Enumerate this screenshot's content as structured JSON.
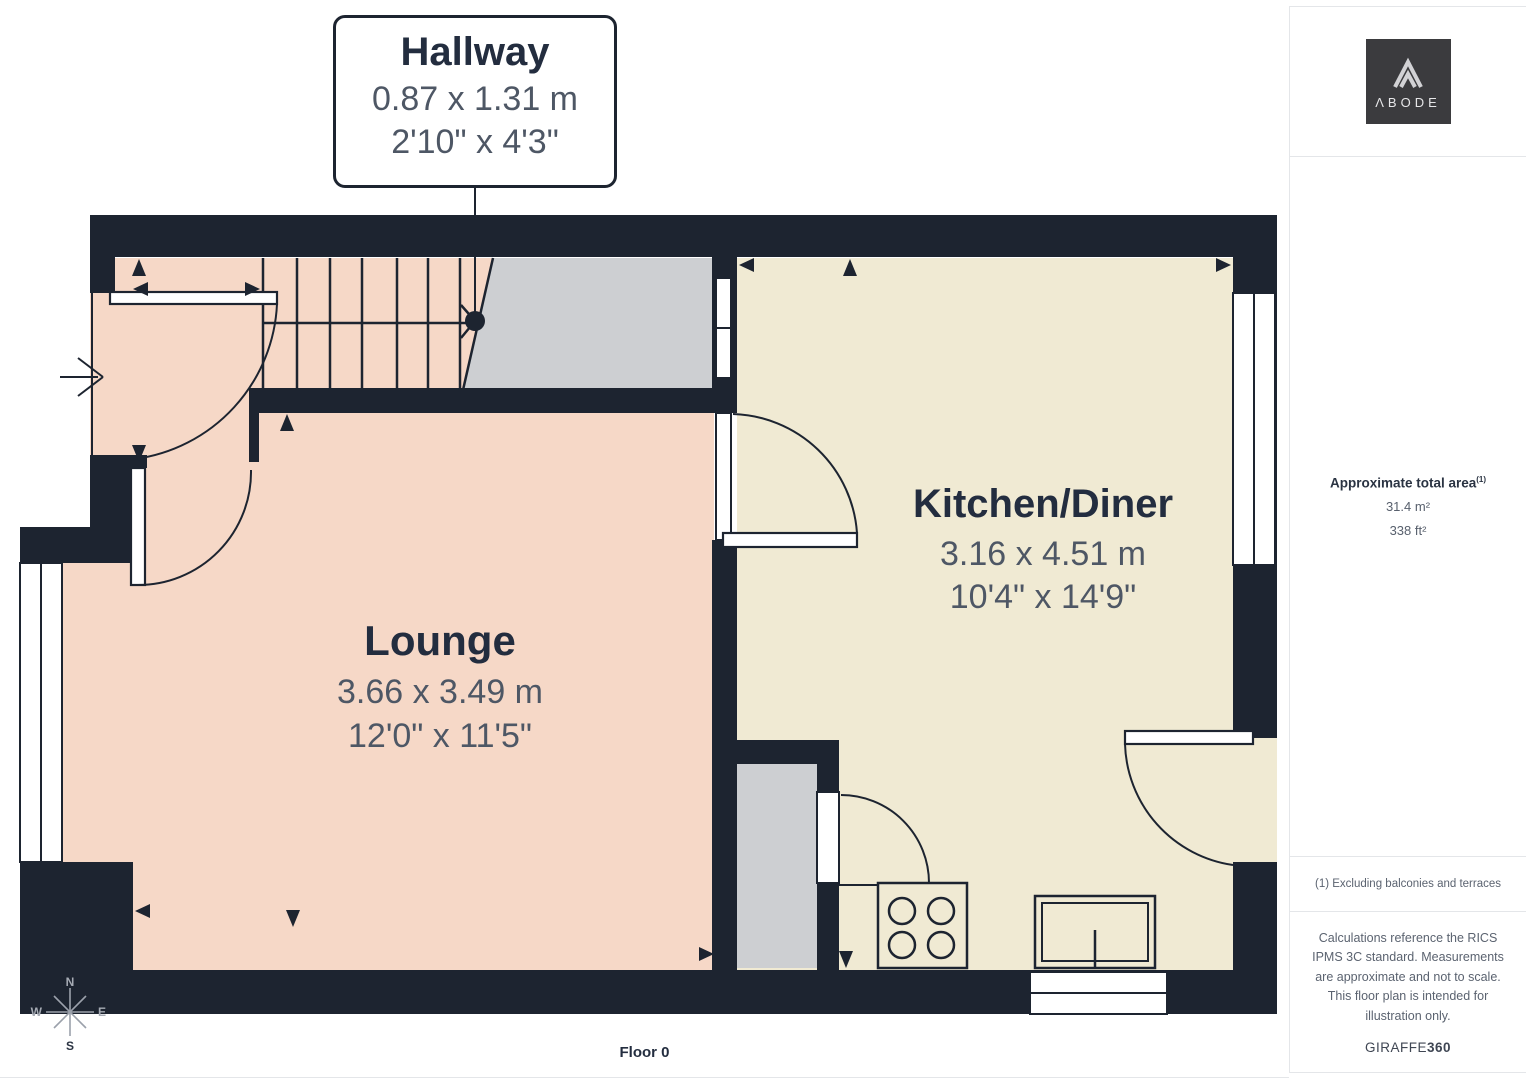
{
  "floor_plan": {
    "callout": {
      "room": "Hallway",
      "metric": "0.87 x 1.31 m",
      "imperial": "2'10\" x 4'3\""
    },
    "rooms": [
      {
        "name": "Lounge",
        "metric": "3.66 x 3.49 m",
        "imperial": "12'0\" x 11'5\""
      },
      {
        "name": "Kitchen/Diner",
        "metric": "3.16 x 4.51 m",
        "imperial": "10'4\" x 14'9\""
      }
    ],
    "floor_label": "Floor 0",
    "compass": {
      "n": "N",
      "e": "E",
      "s": "S",
      "w": "W"
    }
  },
  "sidebar": {
    "logo_text": "ΛBODE",
    "area": {
      "title": "Approximate total area",
      "superscript": "(1)",
      "metric": "31.4 m²",
      "imperial": "338 ft²"
    },
    "note": "(1) Excluding balconies and terraces",
    "disclaimer": "Calculations reference the RICS IPMS 3C standard. Measurements are approximate and not to scale. This floor plan is intended for illustration only.",
    "brand": {
      "name": "GIRAFFE",
      "suffix": "360"
    }
  },
  "colors": {
    "wall": "#1d2430",
    "room_pink": "#f6d8c7",
    "room_cream": "#f0ead3",
    "floor_gray": "#cdcfd2",
    "line": "#1d2430",
    "title_text": "#232d3f",
    "dim_text": "#4e5765",
    "muted_text": "#5b6370",
    "border": "#e4e6e9",
    "logo_bg": "#3b3b3e"
  }
}
